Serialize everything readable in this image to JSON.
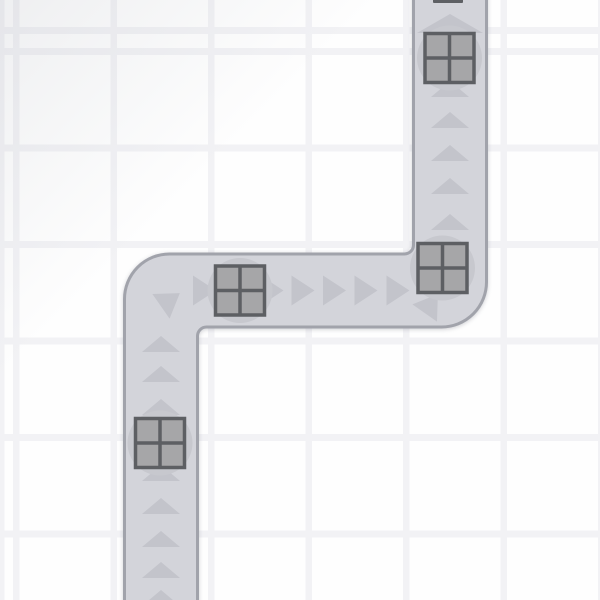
{
  "scene": {
    "canvas": {
      "width": 600,
      "height": 600
    },
    "background": {
      "cell_color": "#fefefe",
      "line_color": "#f2f2f5",
      "vertical_lines": {
        "start": 13,
        "line_width": 6.5,
        "period": 97.5
      },
      "horizontal_lines": {
        "start": 48,
        "line_width": 7,
        "period": 96.5
      },
      "corner_shade_color": "rgba(168,172,182,0.18)",
      "corner_shade_extent": "32%"
    },
    "track": {
      "fill_color": "#d3d4da",
      "border_color": "#a1a3ab",
      "border_width": 3,
      "outline": "M 124.5 605 L 124.5 299 A 45 45 0 0 1 169.5 254 L 404.5 254 A 9 9 0 0 0 413.5 245 L 413.5 -5 L 486.5 -5 L 486.5 282 A 45 45 0 0 1 441.5 327 L 206.5 327 A 9 9 0 0 0 197.5 336 L 197.5 605 Z"
    },
    "chevrons": {
      "color": "#c3c4cb",
      "shapes": {
        "up": "0,-8 19,8 -19,8",
        "up_large": "0,-9.5 33,9.5 -33,9.5",
        "right": "-11,-15 12,0 -11,15"
      },
      "items": [
        {
          "x": 161,
          "y": 598,
          "shape": "up",
          "rotate": 0
        },
        {
          "x": 161,
          "y": 570,
          "shape": "up",
          "rotate": 0
        },
        {
          "x": 161,
          "y": 539,
          "shape": "up",
          "rotate": 0
        },
        {
          "x": 161,
          "y": 506,
          "shape": "up",
          "rotate": 0
        },
        {
          "x": 161,
          "y": 473,
          "shape": "up",
          "rotate": 0
        },
        {
          "x": 161,
          "y": 407,
          "shape": "up",
          "rotate": 0
        },
        {
          "x": 161,
          "y": 374,
          "shape": "up",
          "rotate": 0
        },
        {
          "x": 161,
          "y": 344,
          "shape": "up",
          "rotate": 0
        },
        {
          "x": 170,
          "y": 300,
          "shape": "right",
          "rotate": -35
        },
        {
          "x": 204,
          "y": 290.5,
          "shape": "right",
          "rotate": 0
        },
        {
          "x": 271.5,
          "y": 290.5,
          "shape": "right",
          "rotate": 0
        },
        {
          "x": 302.5,
          "y": 290.5,
          "shape": "right",
          "rotate": 0
        },
        {
          "x": 334,
          "y": 290.5,
          "shape": "right",
          "rotate": 0
        },
        {
          "x": 365.5,
          "y": 290.5,
          "shape": "right",
          "rotate": 0
        },
        {
          "x": 397.5,
          "y": 290.5,
          "shape": "right",
          "rotate": 0
        },
        {
          "x": 431,
          "y": 304,
          "shape": "right",
          "rotate": -55
        },
        {
          "x": 450,
          "y": 222,
          "shape": "up",
          "rotate": 0
        },
        {
          "x": 450,
          "y": 186,
          "shape": "up",
          "rotate": 0
        },
        {
          "x": 450,
          "y": 153,
          "shape": "up",
          "rotate": 0
        },
        {
          "x": 450,
          "y": 120,
          "shape": "up",
          "rotate": 0
        },
        {
          "x": 450,
          "y": 89,
          "shape": "up",
          "rotate": 0
        },
        {
          "x": 450,
          "y": 23.5,
          "shape": "up_large",
          "rotate": 0
        }
      ]
    },
    "blocks": {
      "size": 49,
      "fill_color": "#a6a6a8",
      "border_color": "#5d5f63",
      "border_width": 3.5,
      "base_circle_color": "#c7c8ce",
      "base_circle_radius": 32.5,
      "items": [
        {
          "x": 449.5,
          "y": 58
        },
        {
          "x": 442.5,
          "y": 268
        },
        {
          "x": 240,
          "y": 290.5
        },
        {
          "x": 160,
          "y": 443
        }
      ]
    },
    "clipped_block_edge": {
      "x": 433,
      "y": -1,
      "width": 30,
      "height": 4,
      "color": "#5e6064"
    }
  }
}
